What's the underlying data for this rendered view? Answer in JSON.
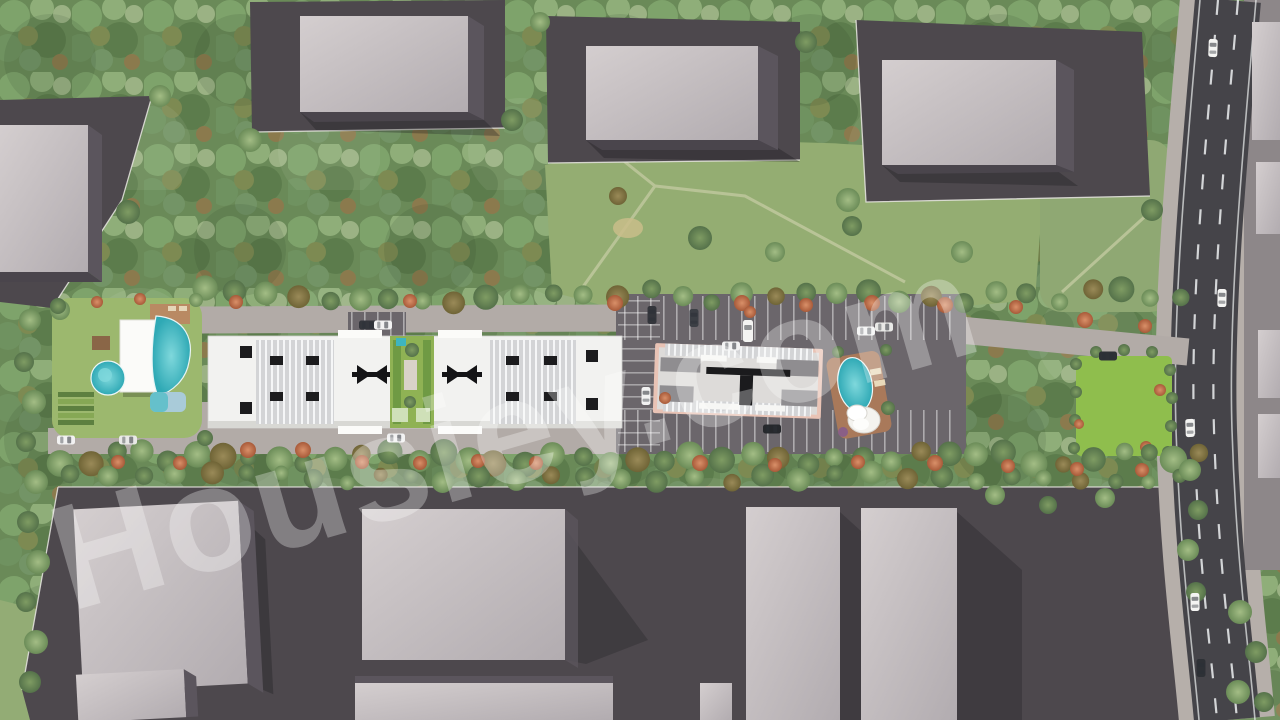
{
  "watermark": {
    "text": "Housiey.com"
  },
  "scene": {
    "kind": "aerial-architectural-render",
    "site": {
      "residential_blocks": 2,
      "amenities": [
        "freeform-pool",
        "round-pool",
        "kids-pool",
        "clubhouse",
        "garden-courtyard",
        "east-oval-pool",
        "cabana",
        "east-lawn",
        "terraced-garden"
      ],
      "parking_cars_visible": 14
    },
    "surroundings": {
      "neighbor_buildings_visible": 10,
      "main_road": {
        "orientation": "vertical-right",
        "lanes": 3,
        "cars_visible": 5
      },
      "tree_belts": [
        "north-forest",
        "south-row",
        "flowering-trees"
      ]
    }
  },
  "palette": {
    "canopy_green": "#6a8a58",
    "meadow_green": "#94ad72",
    "lawn_bright": "#8fbe4d",
    "asphalt_parcel": "#4d484d",
    "road_asphalt": "#454449",
    "drive_concrete": "#b2aba7",
    "roof_light": "#c6c0c3",
    "roof_side_dark": "#5b555d",
    "complex_white": "#f2f2f0",
    "pool_turquoise": "#3cb6c0",
    "deck_wood": "#a9795a",
    "flowering_red": "#c4724d",
    "watermark_white": "rgba(255,255,255,0.30)"
  }
}
